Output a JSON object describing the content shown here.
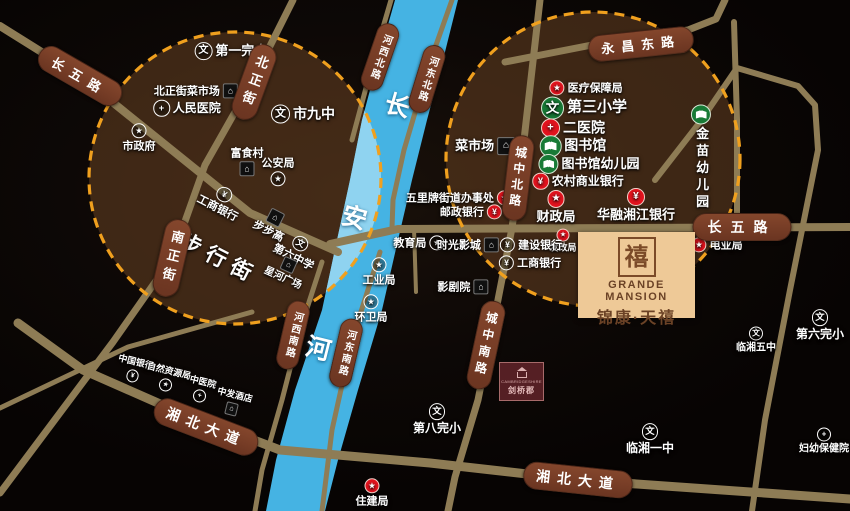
{
  "project": {
    "seal_char": "禧",
    "brand_en": "GRANDE MANSION",
    "brand_cn": "锦康·天禧"
  },
  "secondary_project": {
    "en": "CAMBRIDGESHIRE",
    "cn": "剑桥郡"
  },
  "colors": {
    "bg": "#0e0905",
    "road": "#8e7c55",
    "badge": "#7a3f27",
    "dash": "#f0a01e",
    "river": "#45b3e3",
    "river_light": "#8fd3f0",
    "circle_fill": "rgba(104,65,34,0.55)"
  },
  "circles": [
    {
      "cx": 235,
      "cy": 178,
      "r": 146
    },
    {
      "cx": 593,
      "cy": 159,
      "r": 147
    }
  ],
  "river": {
    "points": "395,0 378,60 362,120 350,180 337,240 322,310 295,390 276,460 266,511 325,511 338,460 358,390 382,310 398,240 412,180 427,120 443,60 458,0"
  },
  "roads": [
    {
      "id": "changwu-road-west",
      "w": 8,
      "pts": "0,26 80,76 250,213 338,252"
    },
    {
      "id": "changwu-road-east",
      "w": 8,
      "pts": "330,244 398,229 850,227"
    },
    {
      "id": "beizheng-nanzheng-road",
      "w": 7,
      "pts": "293,0 252,82 205,165 172,258 113,342 0,493"
    },
    {
      "id": "south-branch-road",
      "w": 5,
      "pts": "252,312 128,347 0,408"
    },
    {
      "id": "xiangbei-road",
      "w": 9,
      "pts": "18,323 83,370 167,407 280,450 430,463 580,480 850,499"
    },
    {
      "id": "hexibei-road",
      "w": 5,
      "pts": "391,0 374,58 352,140"
    },
    {
      "id": "hedongbei-road",
      "w": 5,
      "pts": "452,0 430,62 404,150 393,200 392,228"
    },
    {
      "id": "hexinan-road",
      "w": 5,
      "pts": "322,262 300,330 282,400 262,470 255,511"
    },
    {
      "id": "hedongnan-road",
      "w": 5,
      "pts": "380,252 352,340 332,430 322,511"
    },
    {
      "id": "chengzhong-road",
      "w": 7,
      "pts": "540,0 524,140 512,228 496,310 478,400 455,477 448,511"
    },
    {
      "id": "yongchang-road",
      "w": 7,
      "pts": "505,62 597,44 688,30 716,19 725,0"
    },
    {
      "id": "north-vertical-road",
      "w": 6,
      "pts": "734,22 737,120 737,228"
    },
    {
      "id": "east-arc-road",
      "w": 6,
      "pts": "655,180 700,122 737,68 798,86 815,105 818,150 806,210 790,290 765,420 752,511"
    },
    {
      "id": "cinema-stub-road",
      "w": 4,
      "pts": "414,228 416,292"
    }
  ],
  "road_badges": [
    {
      "id": "changwu-lu-west",
      "t": "长五路",
      "x": 80,
      "y": 76,
      "rot": 30,
      "fs": 13,
      "ls": 8,
      "pad": "3px 14px"
    },
    {
      "id": "beizheng-jie",
      "t": "北正街",
      "x": 254,
      "y": 82,
      "rot": 20,
      "vert": true,
      "fs": 13,
      "ls": 6
    },
    {
      "id": "nanzheng-jie",
      "t": "南正街",
      "x": 172,
      "y": 258,
      "rot": 13,
      "vert": true,
      "fs": 13,
      "ls": 6
    },
    {
      "id": "hexi-beilu",
      "t": "河西北路",
      "x": 380,
      "y": 57,
      "rot": 19,
      "vert": true,
      "fs": 10,
      "ls": 2
    },
    {
      "id": "hedong-beilu",
      "t": "河东北路",
      "x": 427,
      "y": 79,
      "rot": 17,
      "vert": true,
      "fs": 10,
      "ls": 2
    },
    {
      "id": "hexi-nanlu",
      "t": "河西南路",
      "x": 293,
      "y": 335,
      "rot": 13,
      "vert": true,
      "fs": 10,
      "ls": 2
    },
    {
      "id": "hedong-nanlu",
      "t": "河东南路",
      "x": 346,
      "y": 353,
      "rot": 13,
      "vert": true,
      "fs": 10,
      "ls": 2
    },
    {
      "id": "chengzhong-beilu",
      "t": "城中北路",
      "x": 518,
      "y": 178,
      "rot": 7,
      "vert": true,
      "fs": 12,
      "ls": 4
    },
    {
      "id": "chengzhong-nanlu",
      "t": "城中南路",
      "x": 486,
      "y": 345,
      "rot": 12,
      "vert": true,
      "fs": 12,
      "ls": 5
    },
    {
      "id": "yongchang-donglu",
      "t": "永昌东路",
      "x": 641,
      "y": 44,
      "rot": -6,
      "fs": 13,
      "ls": 7,
      "pad": "3px 12px"
    },
    {
      "id": "changwu-lu-east",
      "t": "长五路",
      "x": 742,
      "y": 227,
      "rot": 0,
      "fs": 14,
      "ls": 9,
      "pad": "3px 14px"
    },
    {
      "id": "xiangbei-dadao-west",
      "t": "湘北大道",
      "x": 206,
      "y": 427,
      "rot": 21,
      "fs": 14,
      "ls": 7,
      "pad": "3px 12px"
    },
    {
      "id": "xiangbei-dadao-east",
      "t": "湘北大道",
      "x": 578,
      "y": 480,
      "rot": 6,
      "fs": 14,
      "ls": 7,
      "pad": "3px 12px"
    }
  ],
  "places": [
    {
      "id": "diyi-wanxiao",
      "t": "第一完小",
      "x": 231,
      "y": 51,
      "icon": "school",
      "color": "w",
      "ip": "l",
      "fs": 13
    },
    {
      "id": "beizhengjie-caishichang",
      "t": "北正街菜市场",
      "x": 196,
      "y": 91,
      "icon": "building",
      "ip": "r",
      "fs": 11
    },
    {
      "id": "renmin-yiyuan",
      "t": "人民医院",
      "x": 187,
      "y": 108,
      "icon": "hospital",
      "color": "w",
      "ip": "l",
      "fs": 12
    },
    {
      "id": "shijiuzhong",
      "t": "市九中",
      "x": 303,
      "y": 114,
      "icon": "school",
      "color": "w",
      "ip": "l",
      "fs": 14
    },
    {
      "id": "shizhengfu",
      "t": "市政府",
      "x": 139,
      "y": 138,
      "icon": "gov",
      "color": "w",
      "ip": "t",
      "fs": 11
    },
    {
      "id": "fushicun",
      "t": "富食村",
      "x": 247,
      "y": 162,
      "icon": "building",
      "ip": "b",
      "fs": 11
    },
    {
      "id": "gonganju",
      "t": "公安局",
      "x": 278,
      "y": 172,
      "icon": "gov",
      "color": "w",
      "ip": "b",
      "fs": 11
    },
    {
      "id": "gongshang-yinhang-west",
      "t": "工商银行",
      "x": 221,
      "y": 201,
      "icon": "bank",
      "color": "w",
      "ip": "t",
      "fs": 11,
      "rot": 27
    },
    {
      "id": "bubugao",
      "t": "步步高",
      "x": 272,
      "y": 224,
      "icon": "building",
      "ip": "t",
      "fs": 11,
      "rot": 27
    },
    {
      "id": "diliu-zhongxue",
      "t": "第六中学",
      "x": 297,
      "y": 250,
      "icon": "school",
      "color": "w",
      "ip": "t",
      "fs": 11,
      "rot": 27
    },
    {
      "id": "xinghe-guangchang",
      "t": "星河广场",
      "x": 286,
      "y": 271,
      "icon": "building",
      "ip": "t",
      "fs": 10,
      "rot": 24
    },
    {
      "id": "buxingjie",
      "t": "步行街",
      "x": 219,
      "y": 259,
      "fs": 21,
      "rot": 27,
      "cls": "spread"
    },
    {
      "id": "yiliao-baozhangju",
      "t": "医疗保障局",
      "x": 586,
      "y": 88,
      "icon": "star",
      "color": "r",
      "ip": "l",
      "fs": 11
    },
    {
      "id": "disan-xiaoxue",
      "t": "第三小学",
      "x": 584,
      "y": 108,
      "icon": "school",
      "color": "g",
      "ip": "l",
      "fs": 15
    },
    {
      "id": "er-yiyuan",
      "t": "二医院",
      "x": 573,
      "y": 128,
      "icon": "hospital",
      "color": "r",
      "ip": "l",
      "fs": 14
    },
    {
      "id": "tushuguan",
      "t": "图书馆",
      "x": 573,
      "y": 146,
      "icon": "book",
      "color": "g",
      "ip": "l",
      "fs": 14
    },
    {
      "id": "tushuguan-youeryuan",
      "t": "图书馆幼儿园",
      "x": 589,
      "y": 164,
      "icon": "book",
      "color": "g",
      "ip": "l",
      "fs": 13
    },
    {
      "id": "nongcun-shangye-yinhang",
      "t": "农村商业银行",
      "x": 578,
      "y": 181,
      "icon": "bank",
      "color": "r",
      "ip": "l",
      "fs": 12
    },
    {
      "id": "jinmiao-youeryuan",
      "t": "金苗幼儿园",
      "x": 701,
      "y": 158,
      "icon": "book",
      "color": "g",
      "ip": "t",
      "fs": 13,
      "vert": true
    },
    {
      "id": "caishichang",
      "t": "菜市场",
      "x": 485,
      "y": 146,
      "icon": "building",
      "ip": "r",
      "fs": 13
    },
    {
      "id": "wulipai-jiedao-banshichu",
      "t": "五里牌街道办事处",
      "x": 459,
      "y": 198,
      "icon": "star",
      "color": "r",
      "ip": "r",
      "fs": 11
    },
    {
      "id": "youzheng-yinhang",
      "t": "邮政银行",
      "x": 471,
      "y": 212,
      "icon": "bank",
      "color": "r",
      "ip": "r",
      "fs": 11
    },
    {
      "id": "caizhengju",
      "t": "财政局",
      "x": 556,
      "y": 207,
      "icon": "star",
      "color": "r",
      "ip": "t",
      "fs": 13
    },
    {
      "id": "huarong-xiangjiang-yinhang",
      "t": "华融湘江银行",
      "x": 636,
      "y": 205,
      "icon": "bank",
      "color": "r",
      "ip": "t",
      "fs": 13
    },
    {
      "id": "fagaiju",
      "t": "发改局",
      "x": 563,
      "y": 241,
      "icon": "star",
      "color": "r",
      "ip": "t",
      "fs": 9
    },
    {
      "id": "jianshe-yinhang",
      "t": "建设银行",
      "x": 531,
      "y": 245,
      "icon": "bank",
      "color": "w",
      "ip": "l",
      "fs": 11
    },
    {
      "id": "gongshang-yinhang-east",
      "t": "工商银行",
      "x": 530,
      "y": 263,
      "icon": "bank",
      "color": "w",
      "ip": "l",
      "fs": 11
    },
    {
      "id": "jiaoyuju",
      "t": "教育局",
      "x": 419,
      "y": 243,
      "icon": "gov",
      "color": "w",
      "ip": "r",
      "fs": 11
    },
    {
      "id": "shiguang-yingcheng",
      "t": "时光影城",
      "x": 468,
      "y": 245,
      "icon": "building",
      "ip": "r",
      "fs": 11
    },
    {
      "id": "yingjuyuan",
      "t": "影剧院",
      "x": 463,
      "y": 287,
      "icon": "building",
      "ip": "r",
      "fs": 11
    },
    {
      "id": "gongyeju",
      "t": "工业局",
      "x": 379,
      "y": 272,
      "icon": "gov",
      "color": "w",
      "ip": "t",
      "fs": 11
    },
    {
      "id": "huanweiju",
      "t": "环卫局",
      "x": 371,
      "y": 309,
      "icon": "gov",
      "color": "w",
      "ip": "t",
      "fs": 11
    },
    {
      "id": "dianyeju",
      "t": "电业局",
      "x": 717,
      "y": 245,
      "icon": "star",
      "color": "r",
      "ip": "l",
      "fs": 11
    },
    {
      "id": "diliu-wanxiao",
      "t": "第六完小",
      "x": 820,
      "y": 325,
      "icon": "school",
      "color": "w",
      "ip": "t",
      "fs": 12
    },
    {
      "id": "linxiang-wuzhong",
      "t": "临湘五中",
      "x": 756,
      "y": 340,
      "icon": "school",
      "color": "w",
      "ip": "t",
      "fs": 10
    },
    {
      "id": "linxiang-yizhong",
      "t": "临湘一中",
      "x": 650,
      "y": 439,
      "icon": "school",
      "color": "w",
      "ip": "t",
      "fs": 12
    },
    {
      "id": "fuyou-baojianyuan",
      "t": "妇幼保健院",
      "x": 824,
      "y": 441,
      "icon": "hospital",
      "color": "w",
      "ip": "t",
      "fs": 10
    },
    {
      "id": "diba-wanxiao",
      "t": "第八完小",
      "x": 437,
      "y": 419,
      "icon": "school",
      "color": "w",
      "ip": "t",
      "fs": 12
    },
    {
      "id": "zhujianju",
      "t": "住建局",
      "x": 372,
      "y": 493,
      "icon": "star",
      "color": "r",
      "ip": "t",
      "fs": 11
    },
    {
      "id": "zhongguo-yinhang",
      "t": "中国银行",
      "x": 134,
      "y": 370,
      "icon": "bank",
      "color": "w",
      "ip": "b",
      "fs": 9,
      "rot": 14
    },
    {
      "id": "ziran-ziyuanju",
      "t": "自然资源局",
      "x": 167,
      "y": 379,
      "icon": "gov",
      "color": "w",
      "ip": "b",
      "fs": 9,
      "rot": 14
    },
    {
      "id": "zhongyiyuan",
      "t": "中医院",
      "x": 201,
      "y": 390,
      "icon": "hospital",
      "color": "w",
      "ip": "b",
      "fs": 9,
      "rot": 14
    },
    {
      "id": "zhongfa-jiudian",
      "t": "中发酒店",
      "x": 233,
      "y": 403,
      "icon": "building",
      "ip": "b",
      "fs": 9,
      "rot": 14
    },
    {
      "id": "river-char-chang",
      "t": "长",
      "x": 397,
      "y": 107,
      "fs": 25,
      "rot": 16,
      "cls": "river"
    },
    {
      "id": "river-char-an",
      "t": "安",
      "x": 354,
      "y": 219,
      "fs": 25,
      "rot": 16,
      "cls": "river"
    },
    {
      "id": "river-char-he",
      "t": "河",
      "x": 318,
      "y": 350,
      "fs": 25,
      "rot": 14,
      "cls": "river"
    }
  ]
}
